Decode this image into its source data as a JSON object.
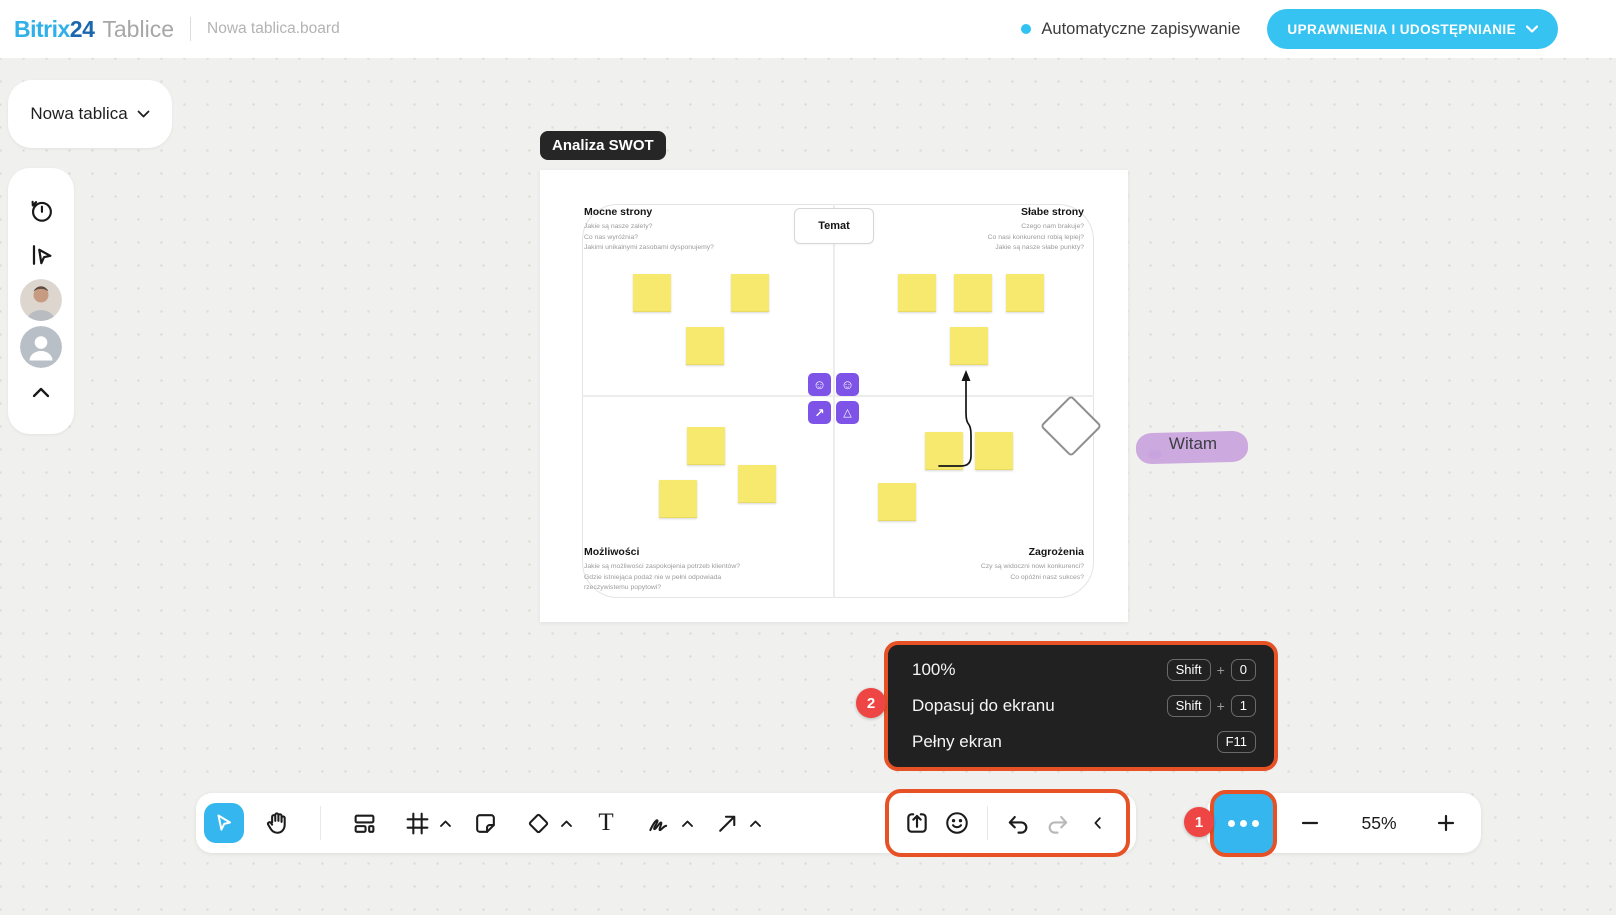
{
  "header": {
    "logo": {
      "bitrix": "Bitrix",
      "two_four": "24",
      "product": "Tablice"
    },
    "breadcrumb": "Nowa tablica.board",
    "autosave_label": "Automatyczne zapisywanie",
    "permissions_button": "UPRAWNIENIA I UDOSTĘPNIANIE"
  },
  "board_selector": {
    "label": "Nowa tablica"
  },
  "frame": {
    "label": "Analiza SWOT"
  },
  "swot": {
    "topic_label": "Temat",
    "strengths": {
      "title": "Mocne strony",
      "questions": "Jakie są nasze zalety?\nCo nas wyróżnia?\nJakimi unikalnymi zasobami dysponujemy?"
    },
    "weaknesses": {
      "title": "Słabe strony",
      "questions": "Czego nam brakuje?\nCo nasi konkurenci robią lepiej?\nJakie są nasze słabe punkty?"
    },
    "opportunities": {
      "title": "Możliwości",
      "questions": "Jakie są możliwości zaspokojenia potrzeb klientów?\nGdzie istniejąca podaż nie w pełni odpowiada\nrzeczywistemu popytowi?"
    },
    "threats": {
      "title": "Zagrożenia",
      "questions": "Czy są widoczni nowi konkurenci?\nCo opóźni nasz sukces?"
    },
    "icon_glyphs": {
      "smiley": "☺",
      "trend": "↗",
      "warning": "△"
    }
  },
  "canvas_note": {
    "text": "Witam"
  },
  "view_menu": {
    "badge": "2",
    "plus": "+",
    "items": [
      {
        "label": "100%",
        "key1": "Shift",
        "key2": "0"
      },
      {
        "label": "Dopasuj do ekranu",
        "key1": "Shift",
        "key2": "1"
      },
      {
        "label": "Pełny ekran",
        "key1": "F11"
      }
    ]
  },
  "toolbar": {
    "text_tool_glyph": "T",
    "more_badge": "1"
  },
  "zoom": {
    "level": "55%"
  },
  "colors": {
    "accent_blue": "#35b6ef",
    "cyan_button": "#36c3f1",
    "orange_highlight": "#e65226",
    "badge_red": "#ee4545",
    "sticky_yellow": "#f7e96d",
    "object_purple": "#7d53e8",
    "note_highlight": "#c9a3dd"
  }
}
